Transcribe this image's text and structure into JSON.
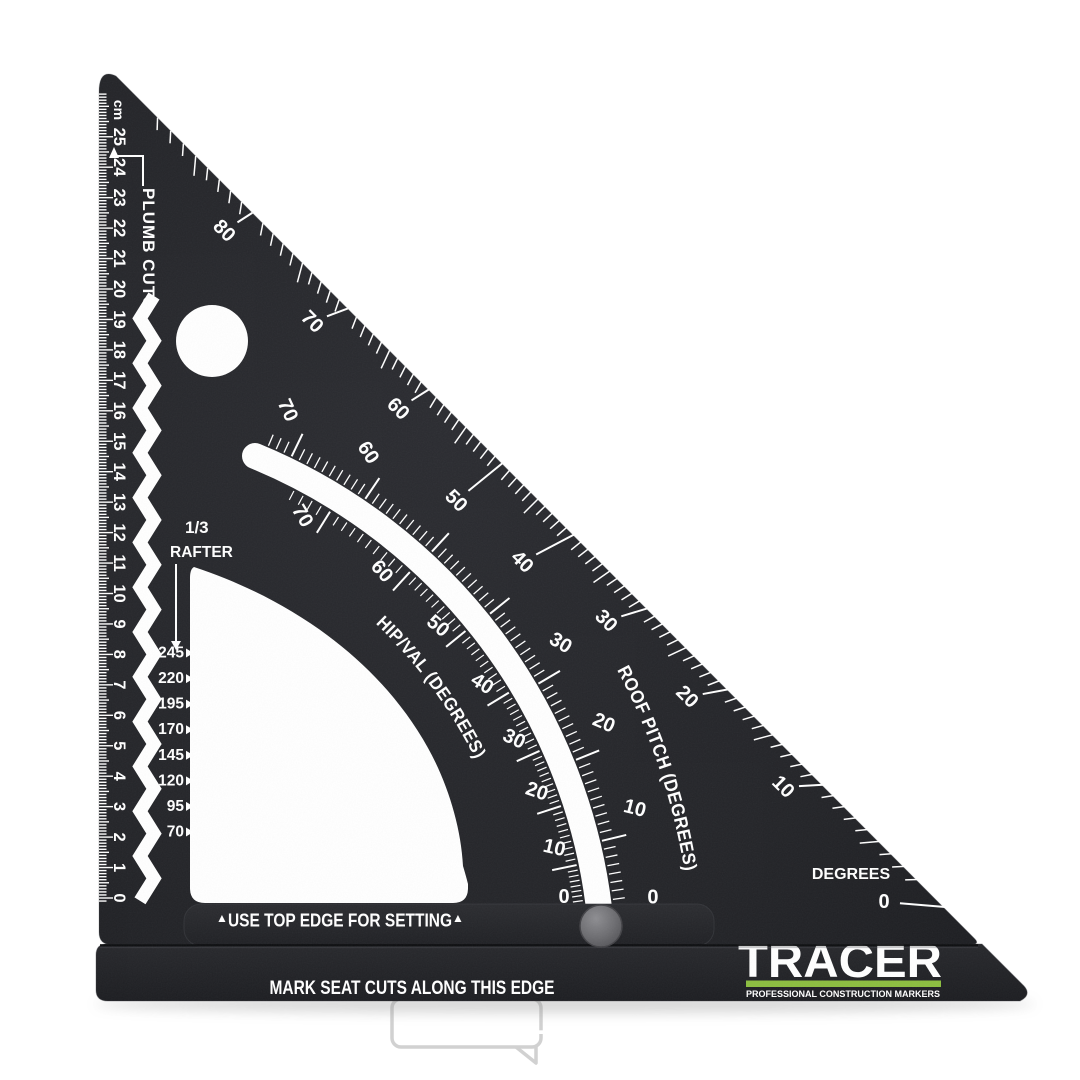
{
  "ruler": {
    "unit": "cm",
    "min": 0,
    "max": 25
  },
  "plumb": {
    "label": "PLUMB CUTS"
  },
  "rafter": {
    "fraction": "1/3",
    "word": "RAFTER",
    "values": [
      "245",
      "220",
      "195",
      "170",
      "145",
      "120",
      "95",
      "70"
    ]
  },
  "degrees": {
    "label": "DEGREES",
    "items": [
      {
        "v": "80",
        "x": 224,
        "y": 231,
        "rot": 45
      },
      {
        "v": "70",
        "x": 312,
        "y": 322,
        "rot": 45
      },
      {
        "v": "60",
        "x": 398,
        "y": 409,
        "rot": 45
      },
      {
        "v": "50",
        "x": 456,
        "y": 501,
        "rot": 45
      },
      {
        "v": "40",
        "x": 522,
        "y": 562,
        "rot": 45
      },
      {
        "v": "30",
        "x": 606,
        "y": 621,
        "rot": 45
      },
      {
        "v": "20",
        "x": 687,
        "y": 697,
        "rot": 45
      },
      {
        "v": "10",
        "x": 783,
        "y": 787,
        "rot": 45
      },
      {
        "v": "0",
        "x": 884,
        "y": 902,
        "rot": 0
      }
    ]
  },
  "roof": {
    "title": "ROOF PITCH (DEGREES)",
    "majors": [
      0,
      10,
      20,
      30,
      40,
      50,
      60,
      70
    ],
    "labeled": [
      0,
      10,
      20,
      30,
      60,
      70
    ]
  },
  "hip": {
    "title": "HIP/VAL (DEGREES)",
    "majors": [
      [
        0,
        6.3
      ],
      [
        10,
        11.7
      ],
      [
        20,
        18.1
      ],
      [
        30,
        24.3
      ],
      [
        40,
        31.2
      ],
      [
        50,
        39.1
      ],
      [
        60,
        47.6
      ],
      [
        70,
        58.1
      ]
    ]
  },
  "fence": {
    "arrow": "▲",
    "label": "USE TOP EDGE FOR SETTING"
  },
  "seat": {
    "label": "MARK SEAT CUTS ALONG THIS EDGE"
  },
  "brand": {
    "name": "TRACER",
    "tagline": "PROFESSIONAL CONSTRUCTION MARKERS",
    "green": "#8cbe3f"
  },
  "watermark": {
    "w1": "SVÁŘEČKY",
    "sep": "-",
    "w2": "OBCHOD.",
    "w3": "CZ"
  },
  "colors": {
    "body": "#222327",
    "white": "#ffffff",
    "knob": "#6e6e72",
    "seat_text": "#c9c9c9",
    "watermark": "#bdbdbd"
  }
}
